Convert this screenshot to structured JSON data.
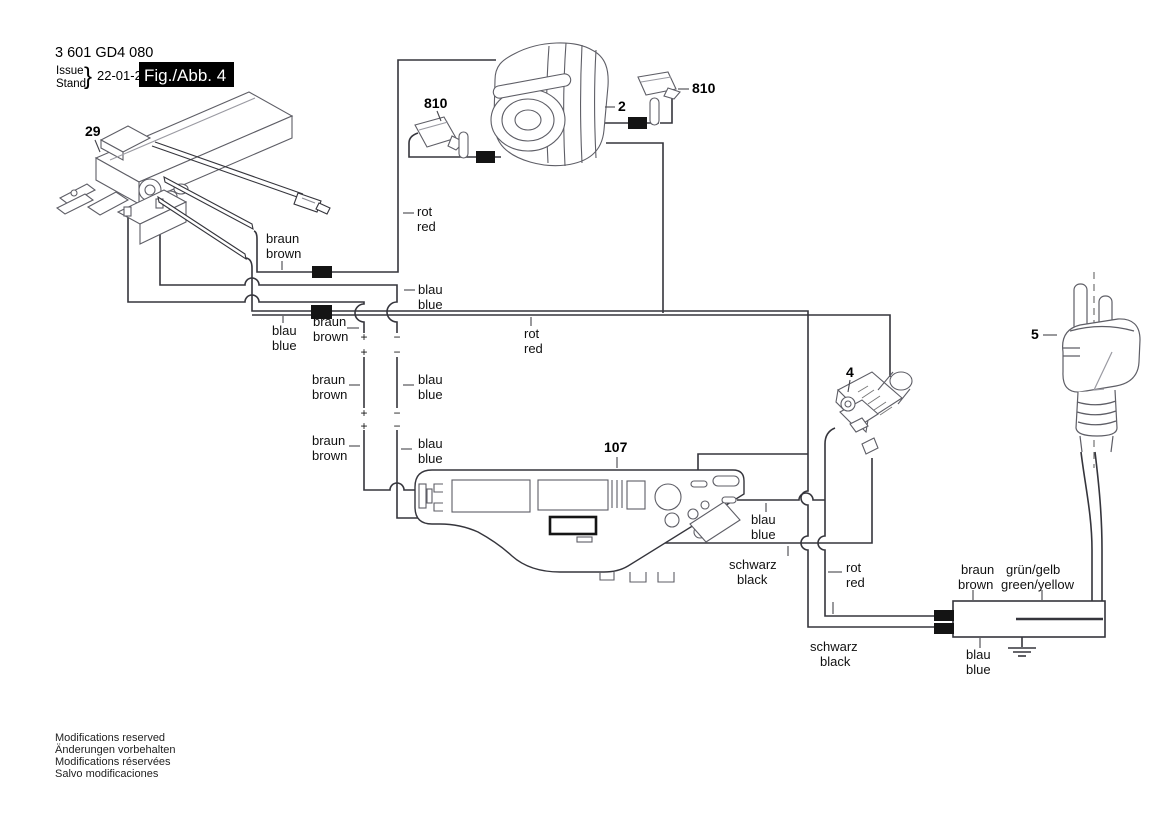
{
  "header": {
    "part_number": "3 601 GD4 080",
    "issue": "Issue",
    "stand": "Stand",
    "brace": "}",
    "date": "22-01-26",
    "figure": "Fig./Abb. 4"
  },
  "part_labels": {
    "switch": "29",
    "field": "2",
    "brush_left": "810",
    "brush_right": "810",
    "module": "4",
    "plug": "5",
    "pcb": "107"
  },
  "wire_labels": {
    "braun": {
      "de": "braun",
      "en": "brown"
    },
    "blau": {
      "de": "blau",
      "en": "blue"
    },
    "rot": {
      "de": "rot",
      "en": "red"
    },
    "schwarz": {
      "de": "schwarz",
      "en": "black"
    },
    "gruen": {
      "de": "grün/gelb",
      "en": "green/yellow"
    }
  },
  "polarity": {
    "plus": "+",
    "minus": "−"
  },
  "footer": {
    "line1": "Modifications reserved",
    "line2": "Änderungen vorbehalten",
    "line3": "Modifications réservées",
    "line4": "Salvo modificaciones"
  },
  "colors": {
    "diagram_line": "#35353c",
    "part_outline": "#5e5e66",
    "ferrite": "#141414",
    "fig_box_bg": "#000000",
    "fig_box_text": "#ffffff"
  }
}
